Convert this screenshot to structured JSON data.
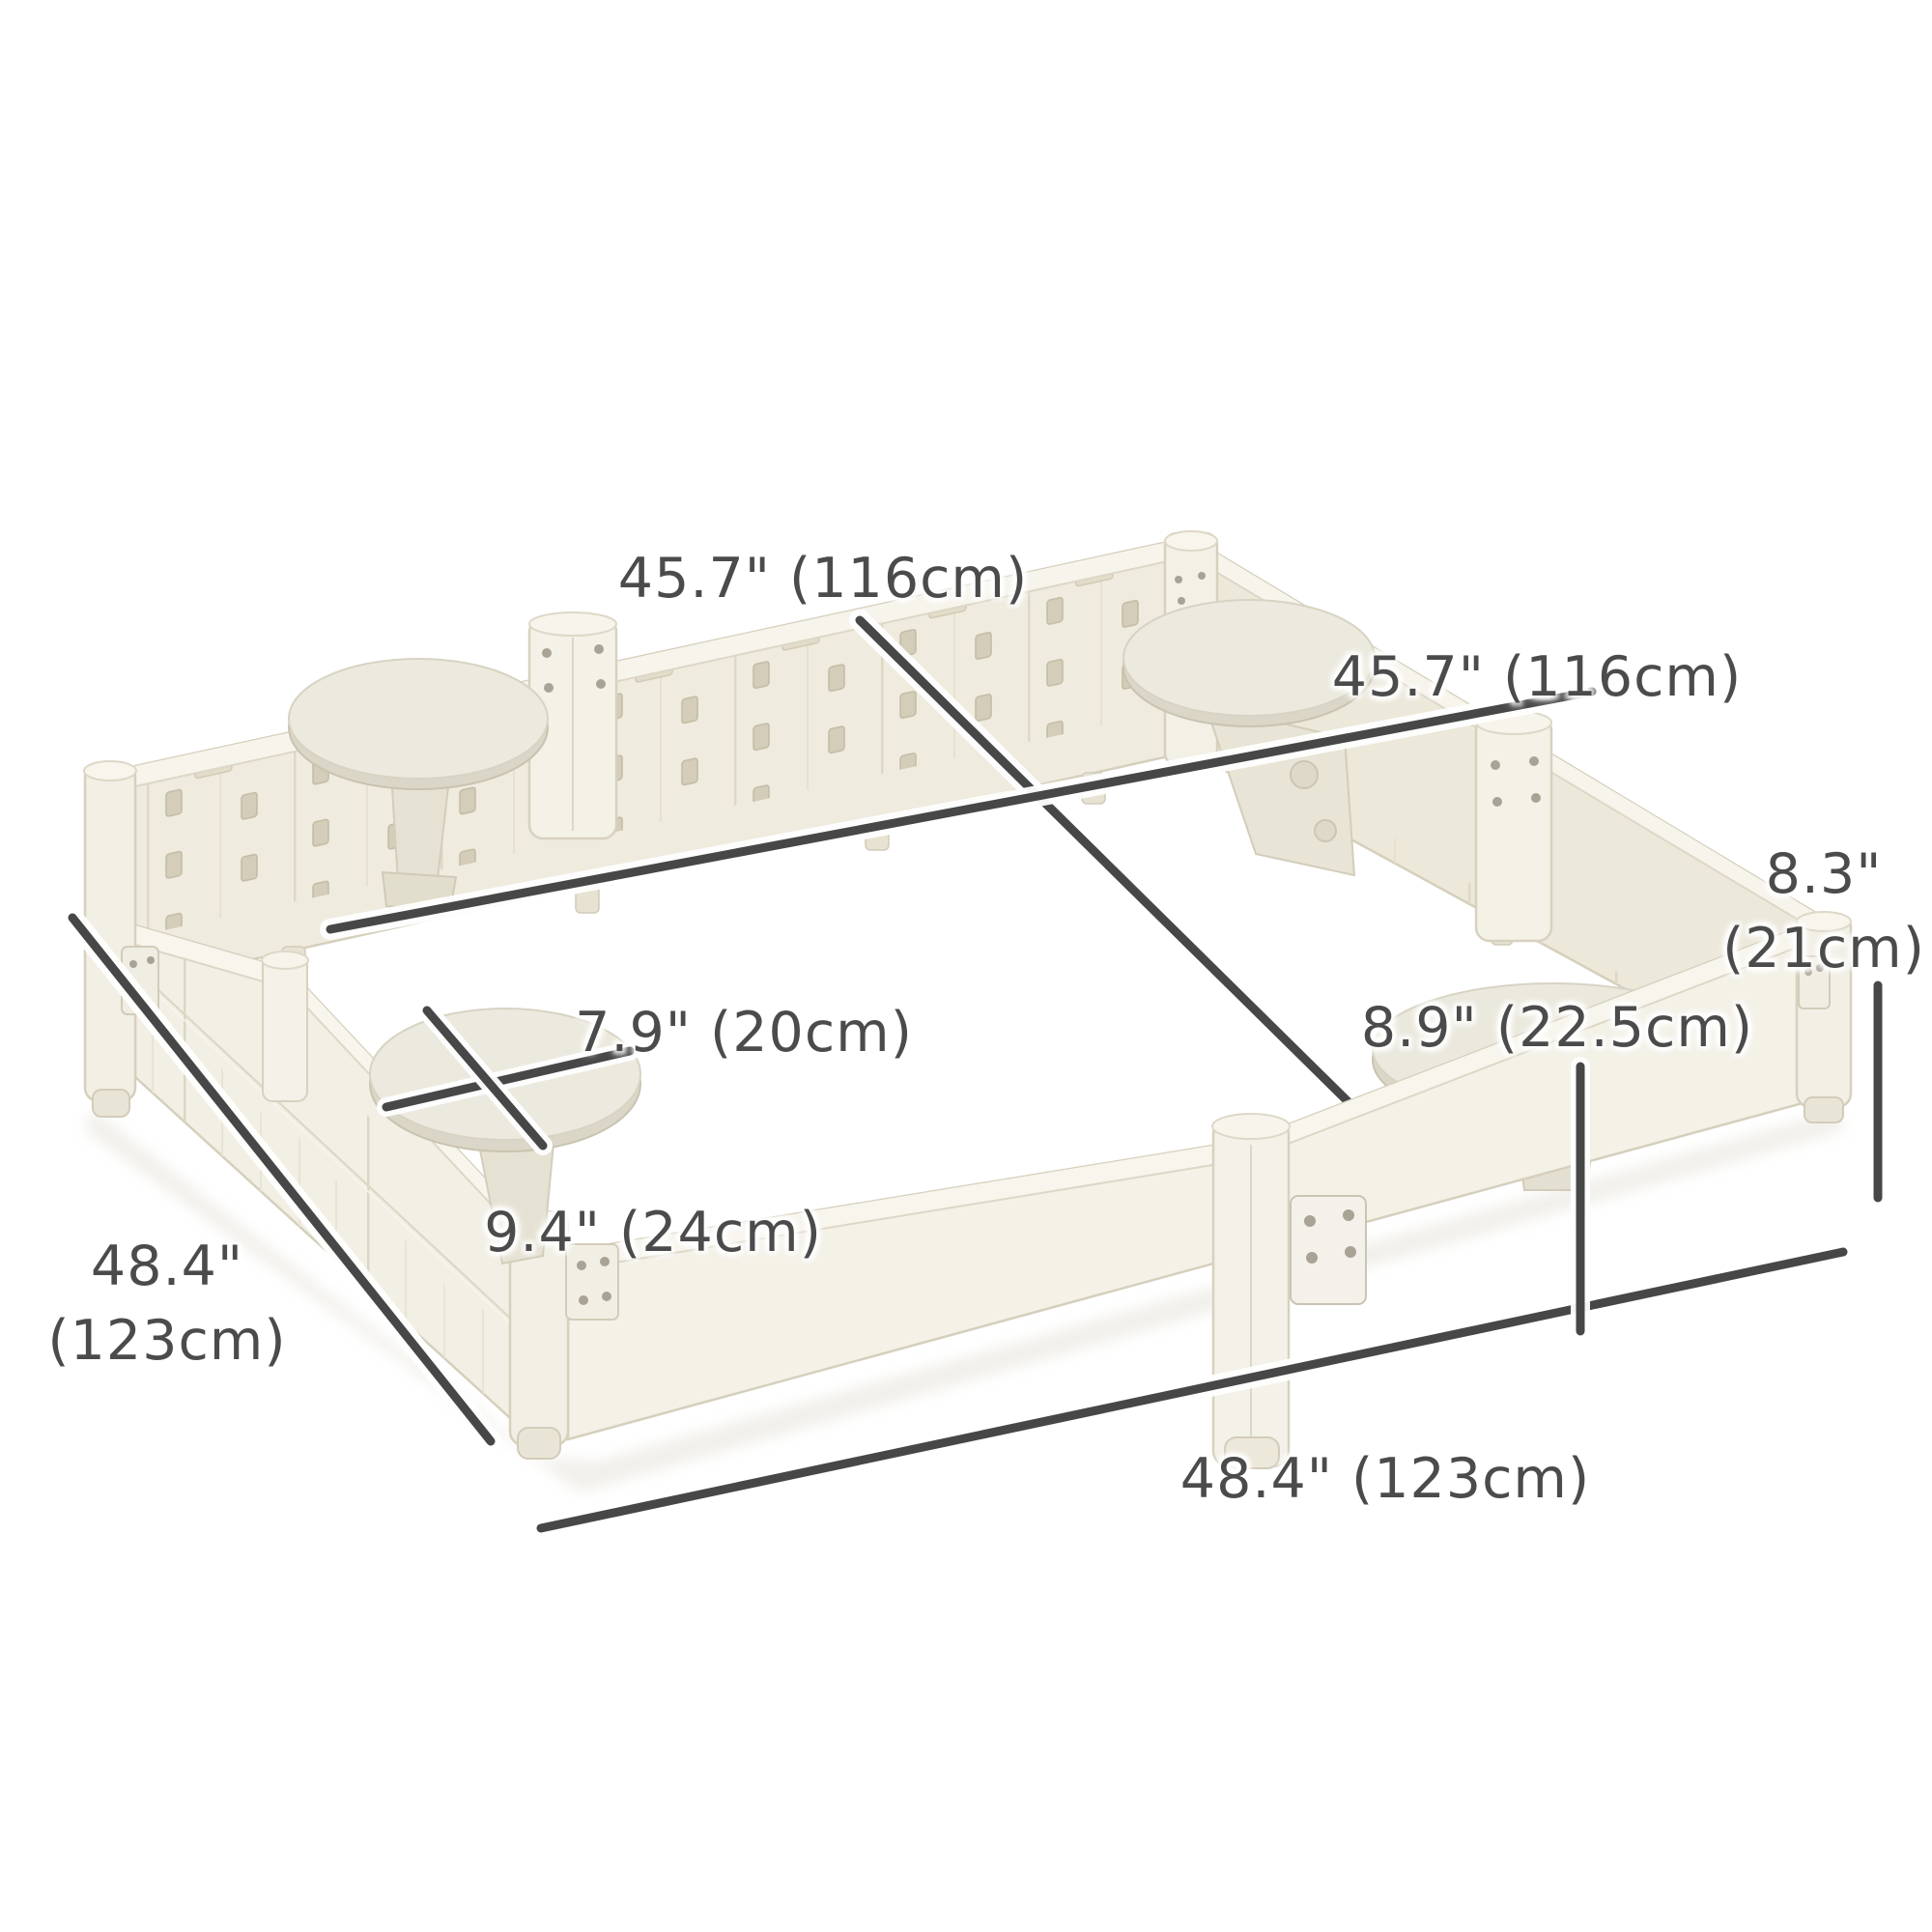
{
  "page": {
    "background": "#ffffff"
  },
  "dimensions": {
    "inner_top": "45.7\" (116cm)",
    "inner_right": "45.7\" (116cm)",
    "wall_height": {
      "line1": "8.3\"",
      "line2": "(21cm)"
    },
    "seat_width": "7.9\" (20cm)",
    "corner_seat_width": "8.9\" (22.5cm)",
    "seat_depth": "9.4\" (24cm)",
    "outer_left": {
      "line1": "48.4\"",
      "line2": "(123cm)"
    },
    "outer_bottom": "48.4\" (123cm)"
  },
  "colors": {
    "dimension_line": "#474747",
    "label_text": "#4b4b4b",
    "wall_base": "#f0ecdf",
    "wall_light": "#f7f4ec",
    "wall_outline": "#d5cfbc",
    "slot_shadow": "#d3cdb9",
    "seat_top": "#eceade",
    "seat_rim": "#dbd7c8"
  }
}
